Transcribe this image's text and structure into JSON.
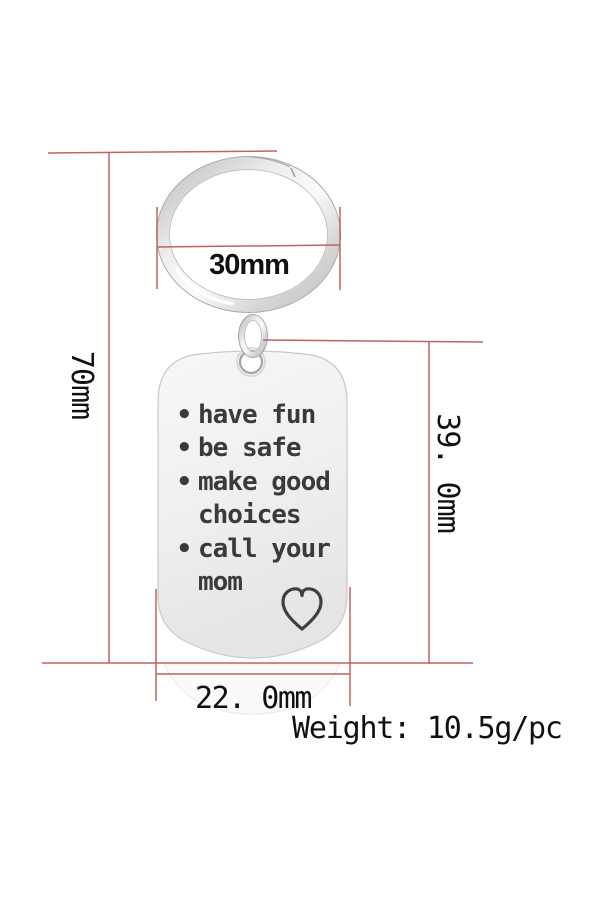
{
  "dimensions": {
    "ring_width": "30mm",
    "total_height": "70mm",
    "tag_height": "39. 0mm",
    "tag_width": "22. 0mm",
    "weight": "Weight: 10.5g/pc"
  },
  "tag": {
    "lines": [
      {
        "bullet": "•",
        "text": "have fun"
      },
      {
        "bullet": "•",
        "text": "be safe"
      },
      {
        "bullet": "•",
        "text": "make good"
      },
      {
        "bullet": "",
        "text": "choices"
      },
      {
        "bullet": "•",
        "text": "call your"
      },
      {
        "bullet": "",
        "text": "mom"
      }
    ],
    "icon": "heart-outline-icon"
  },
  "colors": {
    "dimension_line": "#bf6464",
    "dimension_text": "#111111",
    "engraving_text": "#3a3a3a",
    "metal_light": "#fafafa",
    "metal_dark": "#bdbdbd",
    "background": "#ffffff"
  }
}
